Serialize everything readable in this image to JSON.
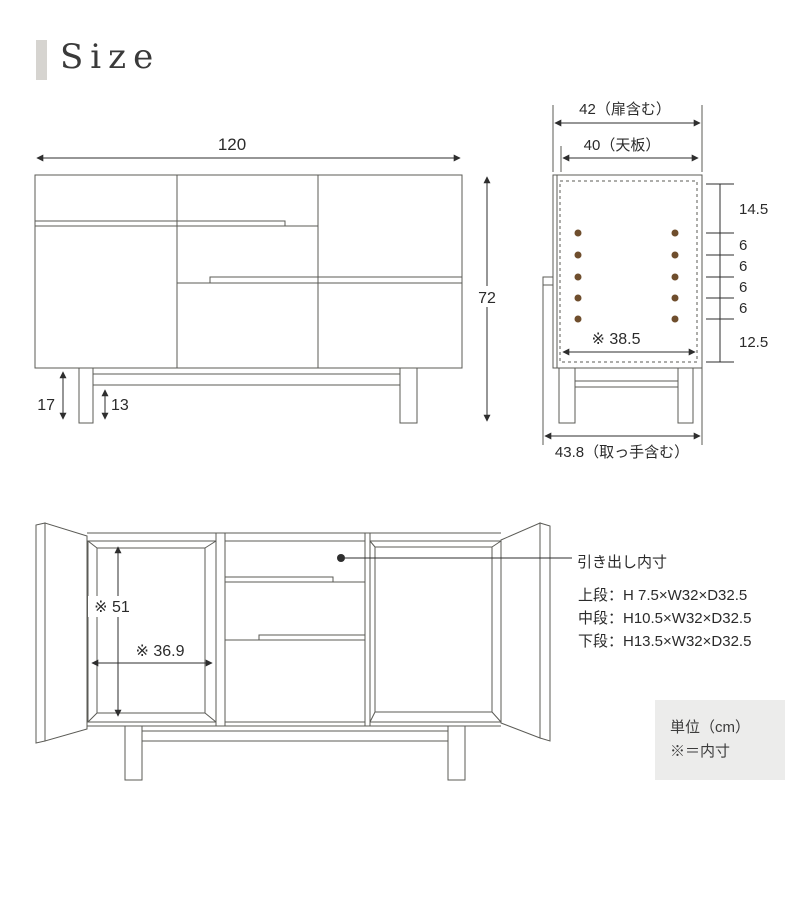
{
  "title": "Size",
  "colors": {
    "line": "#5b5b56",
    "dimension": "#2e2e2e",
    "text": "#2b2b2b",
    "accent_bar": "#d6d4d0",
    "shelf_pin_hole": "#6f4e2d",
    "note_background": "#ececeb"
  },
  "front_view": {
    "width": "120",
    "height": "72",
    "leg_height": "17",
    "rail_clearance": "13"
  },
  "side_view": {
    "depth_with_door": "42（扉含む）",
    "top_panel_depth": "40（天板）",
    "inner_depth": "※ 38.5",
    "depth_with_handle": "43.8（取っ手含む）",
    "pitch": [
      "14.5",
      "6",
      "6",
      "6",
      "6",
      "12.5"
    ]
  },
  "open_view": {
    "inner_height": "※ 51",
    "inner_width": "※ 36.9",
    "drawer_title": "引き出し内寸",
    "drawer_specs": [
      "上段：H 7.5×W32×D32.5",
      "中段：H10.5×W32×D32.5",
      "下段：H13.5×W32×D32.5"
    ]
  },
  "note": {
    "unit": "単位（cm）",
    "legend": "※＝内寸"
  }
}
